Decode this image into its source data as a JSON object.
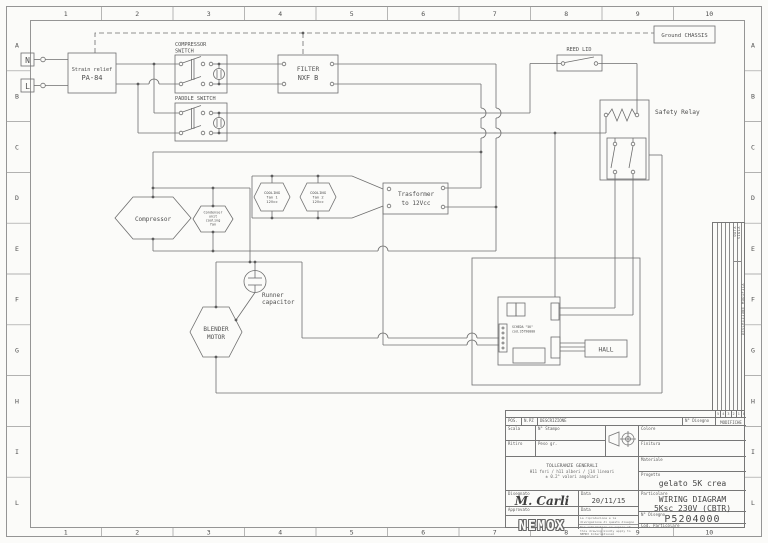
{
  "sheet": {
    "bg": "#fbfbf9",
    "wire_color": "#6e6e6e",
    "text_color": "#4f4f4f"
  },
  "border": {
    "cols": [
      "1",
      "2",
      "3",
      "4",
      "5",
      "6",
      "7",
      "8",
      "9",
      "10"
    ],
    "rows": [
      "A",
      "B",
      "C",
      "D",
      "E",
      "F",
      "G",
      "H",
      "I",
      "L"
    ]
  },
  "schematic": {
    "n_terminal": "N",
    "l_terminal": "L",
    "strain_relief": [
      "Strain relief",
      "PA-84"
    ],
    "compressor_switch": [
      "COMPRESSOR",
      "SWITCH"
    ],
    "paddle_switch": "PADDLE SWITCH",
    "filter": [
      "FILTER",
      "NXF B"
    ],
    "ground_chassis": "Ground CHASSIS",
    "reed_lid": "REED LID",
    "safety_relay": "Safety Relay",
    "compressor": "Compressor",
    "condenser_fan": [
      "Condenser",
      "unit",
      "cooling",
      "fan"
    ],
    "cooling_fan_1": [
      "COOLING",
      "fan 1",
      "12Vcc"
    ],
    "cooling_fan_2": [
      "COOLING",
      "fan 2",
      "12Vcc"
    ],
    "transformer": [
      "Trasformer",
      "to 12Vcc"
    ],
    "runner_capacitor": [
      "Runner",
      "capacitor"
    ],
    "blender_motor": [
      "BLENDER",
      "MOTOR"
    ],
    "board": [
      "SCHEDA \"5K\"",
      "cod.35790000"
    ],
    "hall": "HALL"
  },
  "revision_strip": {
    "data": "DATA",
    "sigla": "SIGLA",
    "descrizione": "DESCRIZIONE  MODIFICA",
    "numbers": [
      "5",
      "4",
      "3",
      "2",
      "1",
      "0"
    ]
  },
  "title_block": {
    "pos": "POS.",
    "npz": "N.PZ",
    "descrizione": "DESCRIZIONE",
    "n_disegno_col": "N° Disegno",
    "modifiche": "MODIFICHE",
    "scala": "Scala",
    "n_stampo": "N° Stampo",
    "ritiro": "Ritiro",
    "peso_gr": "Peso gr.",
    "colore": "Colore",
    "finitura": "Finitura",
    "materiale": "Materiale",
    "tolleranze_1": "TOLLERANZE GENERALI",
    "tolleranze_2": "H11 fori / h11 alberi / j14 lineari",
    "tolleranze_3": "± 0.2° valori angolari",
    "progetto": "Progetto",
    "progetto_value": "gelato 5K crea",
    "particolare": "Particolare",
    "particolare_value_1": "WIRING DIAGRAM",
    "particolare_value_2": "5Ksc 230V (CBTR)",
    "disegnato": "Disegnato",
    "disegnato_value": "M. Carli",
    "data": "Data",
    "data_value": "20/11/15",
    "approvato": "Approvato",
    "data2": "Data",
    "n_disegno": "N° Disegno",
    "n_disegno_value": "P5204000",
    "cod_particolare": "Cod. Particolare",
    "logo": "NEMOX",
    "note_1": "La riproduzione e la divulgazione di questo disegno sono vietate senza nostra autorizzazione scritta",
    "note_2": "For information or copies of this drawing kindly apply to NEMOX International"
  }
}
